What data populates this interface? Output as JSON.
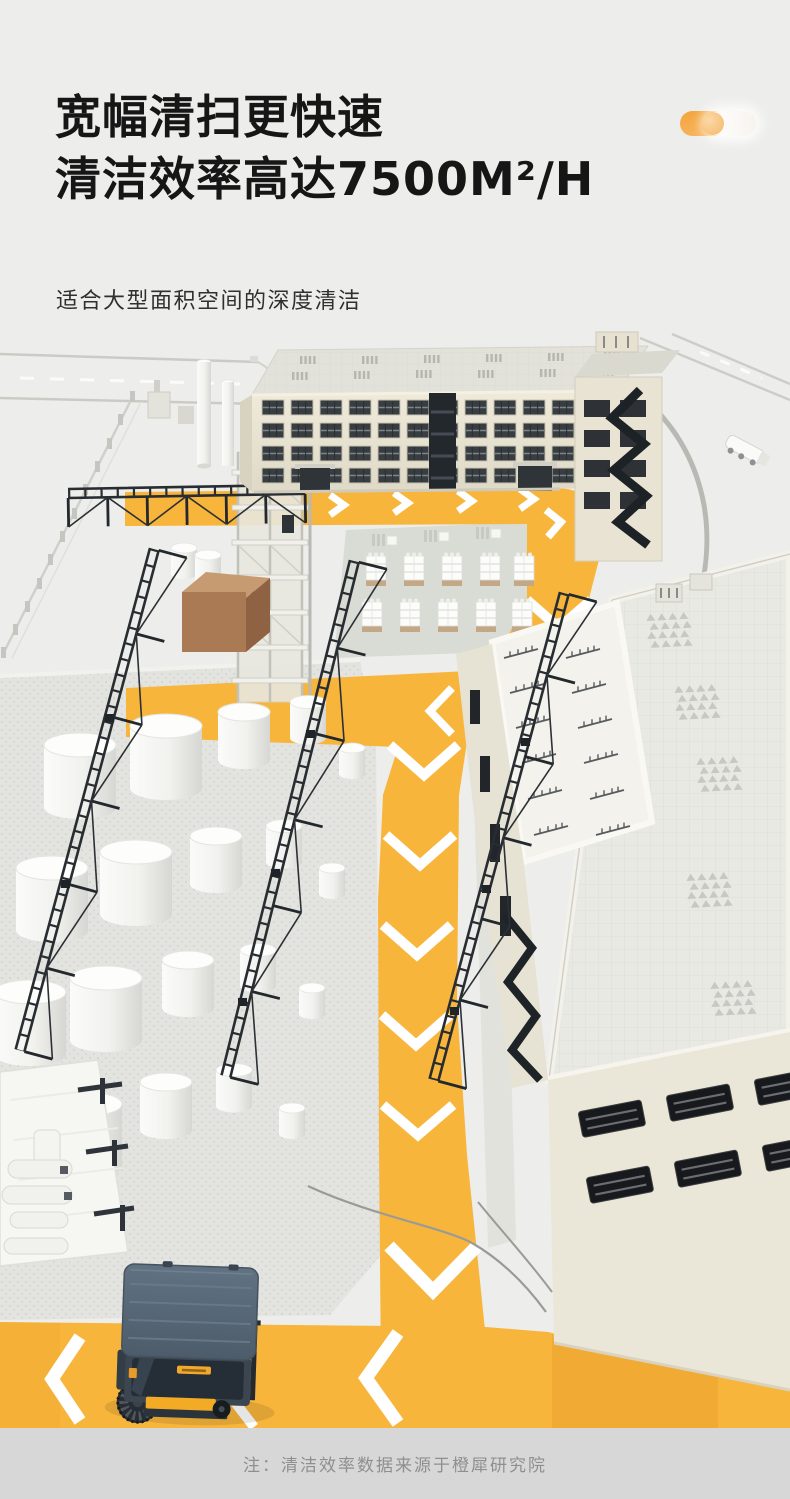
{
  "header": {
    "title_line1": "宽幅清扫更快速",
    "title_line2": "清洁效率高达7500M²/H",
    "subtitle": "适合大型面积空间的深度清洁",
    "toggle_icon": "toggle-decoration"
  },
  "footer": {
    "note": "注：清洁效率数据来源于橙犀研究院"
  },
  "colors": {
    "background": "#EDEDEB",
    "accent_yellow": "#F8B53C",
    "accent_orange": "#F2A43C",
    "title_text": "#161616",
    "subtitle_text": "#303030",
    "note_text": "#8F8F8F",
    "footer_strip": "#D7D7D7",
    "path_chevron": "#FFFFFF",
    "sweeper_body": "#56687A",
    "sweeper_accent": "#F3AB25"
  },
  "scene": {
    "elements": [
      "factory-building",
      "warehouse-building",
      "tank-farm",
      "pallet-stacks",
      "yellow-cleaning-path",
      "ride-on-sweeper",
      "loading-canopy",
      "perimeter-roads"
    ]
  }
}
